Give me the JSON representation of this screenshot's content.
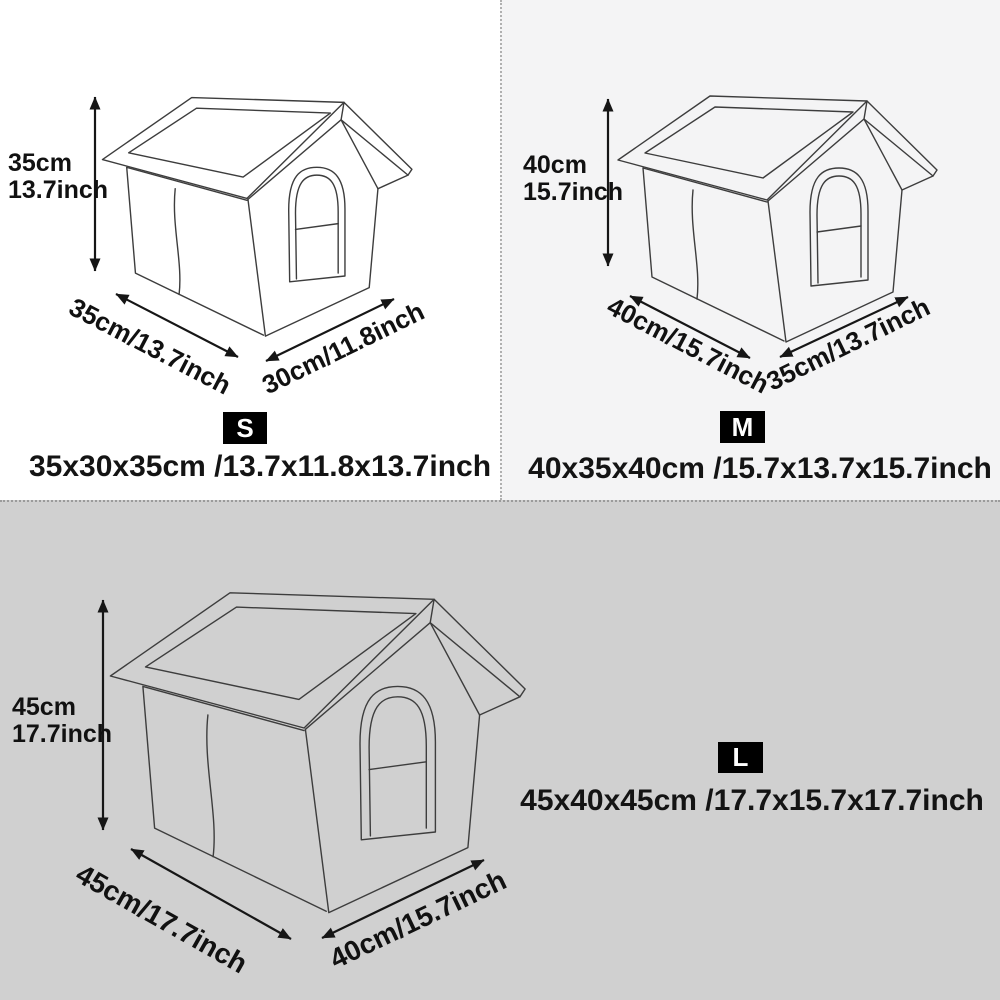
{
  "colors": {
    "panel_s_bg": "#ffffff",
    "panel_m_bg": "#f4f4f5",
    "panel_l_bg": "#d0d0d0",
    "line_art": "#3d3d3d",
    "text": "#111111",
    "badge_bg": "#000000",
    "badge_text": "#ffffff"
  },
  "sizes": [
    {
      "badge": "S",
      "height_line1": "35cm",
      "height_line2": "13.7inch",
      "width_label": "35cm/13.7inch",
      "depth_label": "30cm/11.8inch",
      "summary": "35x30x35cm /13.7x11.8x13.7inch"
    },
    {
      "badge": "M",
      "height_line1": "40cm",
      "height_line2": "15.7inch",
      "width_label": "40cm/15.7inch",
      "depth_label": "35cm/13.7inch",
      "summary": "40x35x40cm /15.7x13.7x15.7inch"
    },
    {
      "badge": "L",
      "height_line1": "45cm",
      "height_line2": "17.7inch",
      "width_label": "45cm/17.7inch",
      "depth_label": "40cm/15.7inch",
      "summary": "45x40x45cm /17.7x15.7x17.7inch"
    }
  ]
}
